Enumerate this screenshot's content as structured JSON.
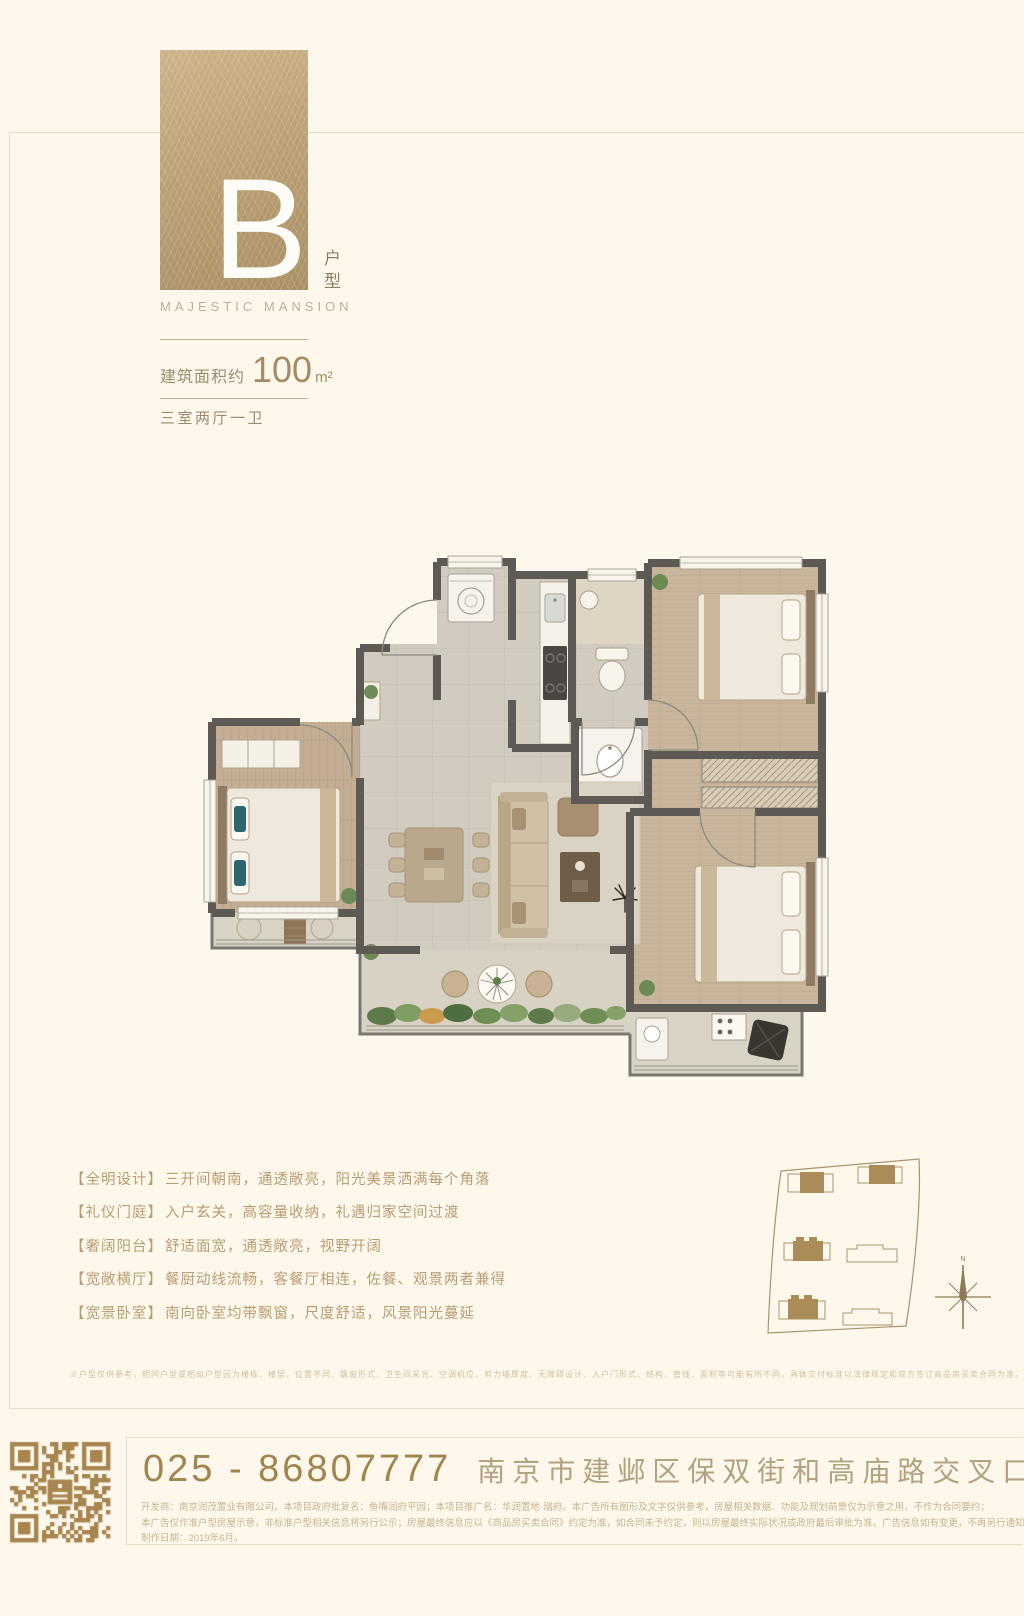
{
  "brand": {
    "letter": "B",
    "unit_type": "户型",
    "name": "MAJESTIC MANSION"
  },
  "area": {
    "label": "建筑面积约",
    "value": "100",
    "unit": "m²",
    "rooms": "三室两厅一卫"
  },
  "features": [
    {
      "label": "【全明设计】",
      "text": "三开间朝南，通透敞亮，阳光美景洒满每个角落"
    },
    {
      "label": "【礼仪门庭】",
      "text": "入户玄关，高容量收纳，礼遇归家空间过渡"
    },
    {
      "label": "【奢阔阳台】",
      "text": "舒适面宽，通透敞亮，视野开阔"
    },
    {
      "label": "【宽敞横厅】",
      "text": "餐厨动线流畅，客餐厅相连，佐餐、观景两者兼得"
    },
    {
      "label": "【宽景卧室】",
      "text": "南向卧室均带飘窗，尺度舒适，风景阳光蔓延"
    }
  ],
  "fine_disclaimer": "※户型仅供参考，相同户型或相似户型因为楼栋、楼层、位置不同、飘窗形式、卫生间采光、空调机位、剪力墙厚度、无障碍设计、入户门形式、结构、管线、面积等可能有所不同，具体交付标准以法律规定和双方签订商品房买卖合同为准。",
  "siteplan": {
    "compass": "N"
  },
  "contact": {
    "phone": "025 - 86807777",
    "address": "南京市建邺区保双街和高庙路交叉口",
    "fineprint": [
      "开发商：南京润茂置业有限公司。本项目政府批复名：鱼嘴润府平园；本项目推广名：华润置地·瑞府。本广告所有图形及文字仅供参考，房屋相关数据、功能及规划前景仅为示意之用，不作为合同要约；",
      "本广告仅作准户型房屋示意，非标准户型相关信息将另行公示；房屋最终信息应以《商品房买卖合同》约定为准，如合同未予约定，则以房屋最终实际状况或政府最后审批为准。广告信息如有变更，不再另行通知。",
      "制作日期：2019年6月。"
    ]
  },
  "colors": {
    "accent_brown": "#b49a6e",
    "qr": "#a8854f",
    "phone": "#a0854f",
    "address": "#b2a282",
    "wall": "#5d5a55"
  }
}
